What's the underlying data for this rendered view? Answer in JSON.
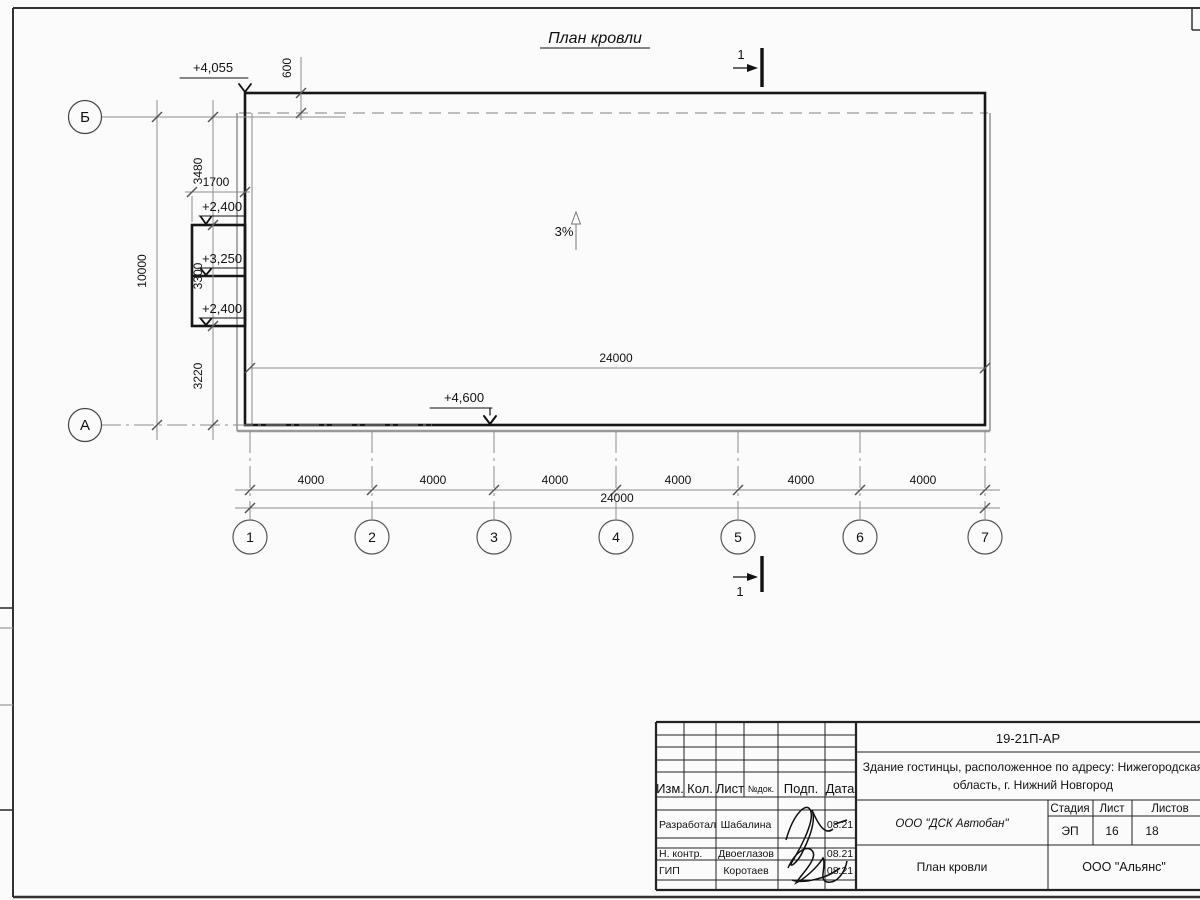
{
  "title": "План кровли",
  "plan": {
    "slope": "3%",
    "section_mark": "1",
    "elevations": {
      "roof_corner": "+4,055",
      "canopy_top": "+2,400",
      "canopy_mid": "+3,250",
      "canopy_bottom": "+2,400",
      "roof_bottom": "+4,600"
    },
    "dims": {
      "top_overhang": "600",
      "left_total": "10000",
      "left_segments": [
        "3480",
        "3300",
        "3220"
      ],
      "canopy_width": "1700",
      "inner_total": "24000",
      "bottom_spans": [
        "4000",
        "4000",
        "4000",
        "4000",
        "4000",
        "4000"
      ],
      "bottom_total": "24000"
    },
    "axes": {
      "horizontal": [
        "Б",
        "А"
      ],
      "vertical": [
        "1",
        "2",
        "3",
        "4",
        "5",
        "6",
        "7"
      ]
    }
  },
  "title_block": {
    "doc_number": "19-21П-АР",
    "project_line1": "Здание гостинцы, расположенное по адресу: Нижегородская",
    "project_line2": "область, г. Нижний Новгород",
    "columns": [
      "Изм.",
      "Кол.",
      "Лист",
      "№док.",
      "Подп.",
      "Дата"
    ],
    "rows": [
      {
        "role": "Разработал",
        "name": "Шабалина",
        "date": "08.21"
      },
      {
        "role": "Н. контр.",
        "name": "Двоеглазов",
        "date": "08.21"
      },
      {
        "role": "ГИП",
        "name": "Коротаев",
        "date": "08.21"
      }
    ],
    "organization": "ООО \"ДСК Автобан\"",
    "stage_label": "Стадия",
    "sheet_label": "Лист",
    "sheets_label": "Листов",
    "stage": "ЭП",
    "sheet": "16",
    "sheets": "18",
    "drawing_name": "План кровли",
    "company": "ООО \"Альянс\""
  }
}
